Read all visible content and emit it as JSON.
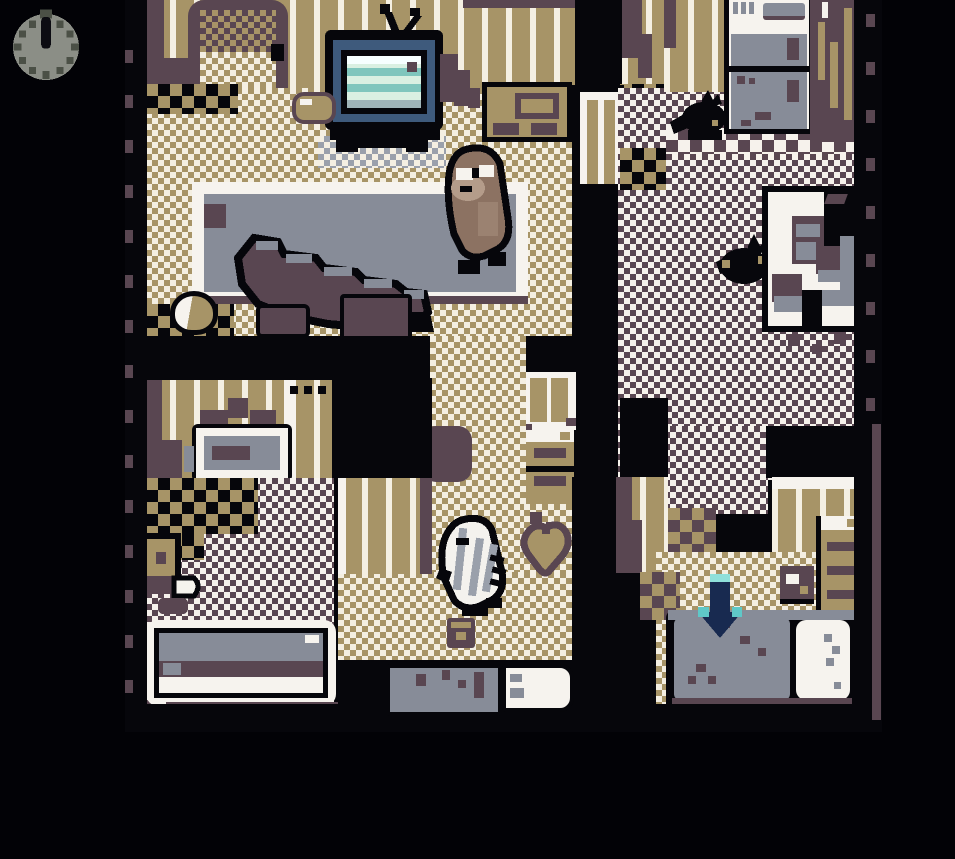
{
  "app": {
    "title": "Game Boy style apartment interior scene",
    "resolution": "160x144 scaled 6x"
  },
  "hud": {
    "clock": {
      "label": "time-of-day clock indicator",
      "hand_position": "12 o'clock",
      "face_color": "#8b8e86",
      "tick_color": "#4b5046"
    }
  },
  "palette": {
    "black": "#06060b",
    "cream": "#f4efe2",
    "tan": "#a79467",
    "purple": "#594651",
    "slate_gray": "#878c98",
    "white": "#f6f3ee",
    "tv_teal": "#7fc6bd",
    "tv_mint": "#d9f0e2",
    "tv_bezel_blue": "#3e5a7c",
    "arrow_navy": "#182a50",
    "arrow_teal": "#8fe0da",
    "npc_brown": "#8c7262",
    "npc_light_brown": "#b49c8a"
  },
  "scene": {
    "name": "top-down apartment interior",
    "rooms": [
      "living-room",
      "bathroom",
      "hallway",
      "kitchen",
      "bedroom"
    ],
    "objects": {
      "viewport": "game viewport",
      "clock": "clock HUD indicator",
      "door": "front door with knob",
      "tv": "CRT television on stand",
      "sideboard": "tan sideboard cabinet",
      "cushion": "floor cushion",
      "table": "long gray table",
      "npc": "brown creature NPC",
      "fallen_shelf": "fallen dark shelf/object",
      "pot": "round pot on floor",
      "debris": "scattered debris",
      "vanity": "bathroom sink vanity",
      "toilet": "toilet",
      "bathtub": "bathtub",
      "bathmat": "bath mat",
      "window_shelf": "hallway window panel",
      "hall_drawers": "hallway drawer chest",
      "player": "white creature player character",
      "heart": "heart-shaped cushion",
      "radio": "small floor object",
      "rug_gray": "gray doormat",
      "rug_white": "white doormat",
      "fridge": "refrigerator",
      "cat1": "black cat",
      "cat2": "black cat",
      "kitchen_table": "kitchen table with dishes and chair",
      "bedroom_chest": "bedroom drawer chest",
      "bedside_box": "purple bedside box",
      "bed": "bed with gray blanket and white pillow",
      "arrow": "downward arrow marker above bed"
    }
  }
}
